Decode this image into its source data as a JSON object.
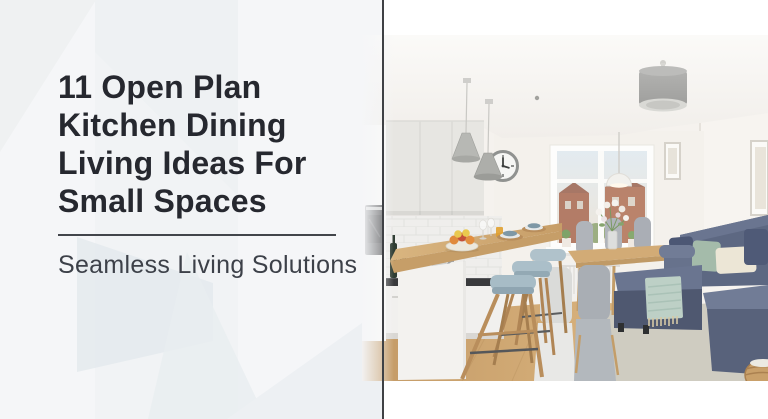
{
  "hero": {
    "title": "11 Open Plan Kitchen Dining Living Ideas For Small Spaces",
    "title_lines": [
      "11 Open Plan",
      "Kitchen Dining",
      "Living Ideas For",
      "Small Spaces"
    ],
    "subtitle": "Seamless Living Solutions"
  },
  "style": {
    "panel_background": "#f5f6f8",
    "title_color": "#26282f",
    "subtitle_color": "#3d4149",
    "divider_color": "#42454b",
    "separator_line_color": "#3f4145"
  },
  "photo": {
    "description": "Bright open-plan room: white kitchen with grey cone pendant lights and a wall clock, wooden breakfast bar with three blue-grey stools, dining table with white flowers by a window, blue-grey corner sofa with sage, cream and navy cushions, mint throw with fringe, beige rug and a wicker basket",
    "palette": {
      "sofa": "#5f6a84",
      "wood": "#cda672",
      "stool_seat": "#a7bcc6",
      "throw": "#bdd0c6",
      "cushion_sage": "#a4bbaa",
      "cushion_cream": "#ece6d6",
      "cushion_navy": "#4b5673",
      "rug": "#cfccc1",
      "outside_brick": "#aa6a52"
    }
  }
}
